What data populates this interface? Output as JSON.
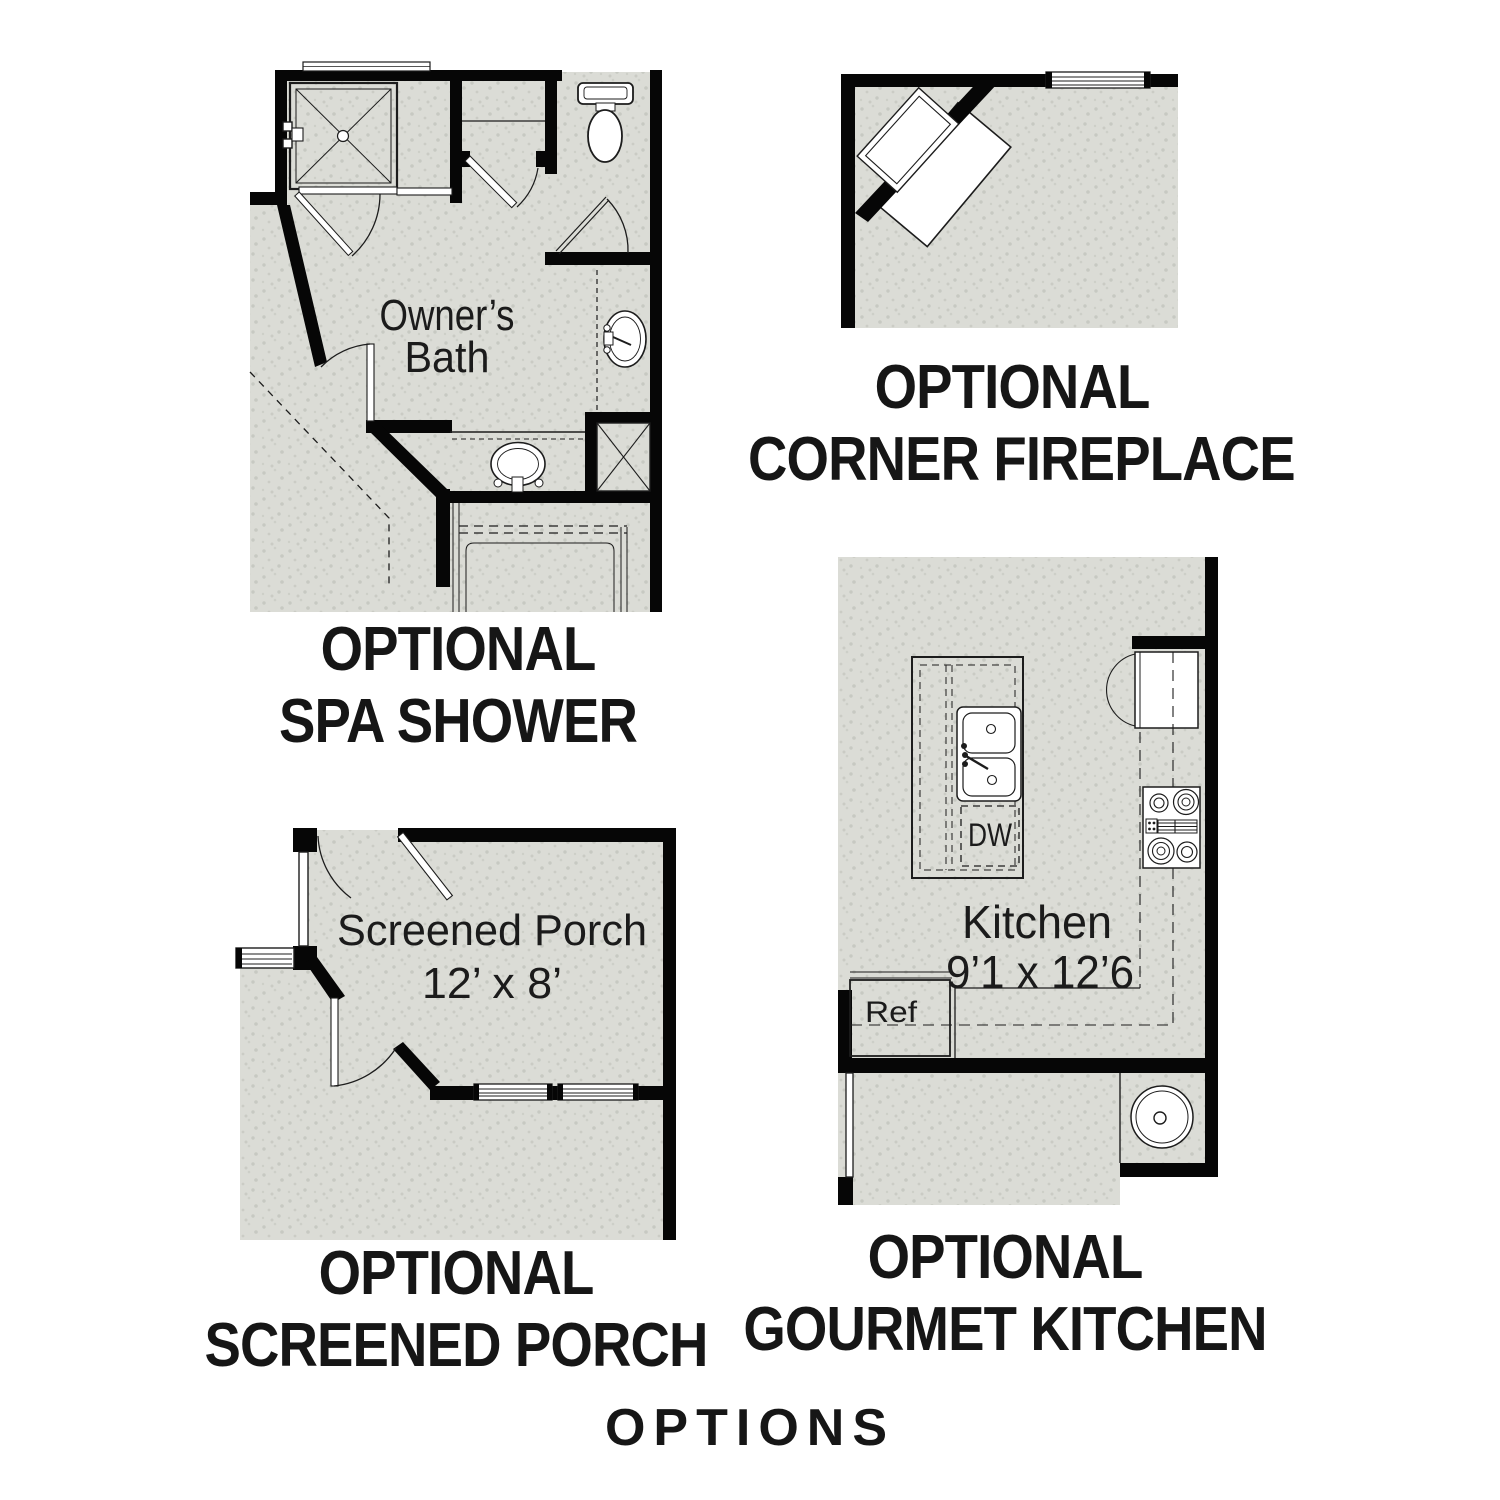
{
  "footer": {
    "label": "OPTIONS"
  },
  "colors": {
    "wall": "#060606",
    "floor": "#dbdcd6",
    "speckle": "#c7c9c2",
    "text": "#1b1b1b"
  },
  "plans": {
    "spa_shower": {
      "caption": [
        "OPTIONAL",
        "SPA SHOWER"
      ],
      "room_label": [
        "Owner’s",
        "Bath"
      ]
    },
    "corner_fireplace": {
      "caption": [
        "OPTIONAL",
        "CORNER FIREPLACE"
      ]
    },
    "screened_porch": {
      "caption": [
        "OPTIONAL",
        "SCREENED PORCH"
      ],
      "room_label": [
        "Screened Porch",
        "12’ x 8’"
      ]
    },
    "gourmet_kitchen": {
      "caption": [
        "OPTIONAL",
        "GOURMET KITCHEN"
      ],
      "room_label": [
        "Kitchen",
        "9’1 x 12’6"
      ],
      "fixtures": {
        "dishwasher": "DW",
        "refrigerator": "Ref"
      }
    }
  }
}
